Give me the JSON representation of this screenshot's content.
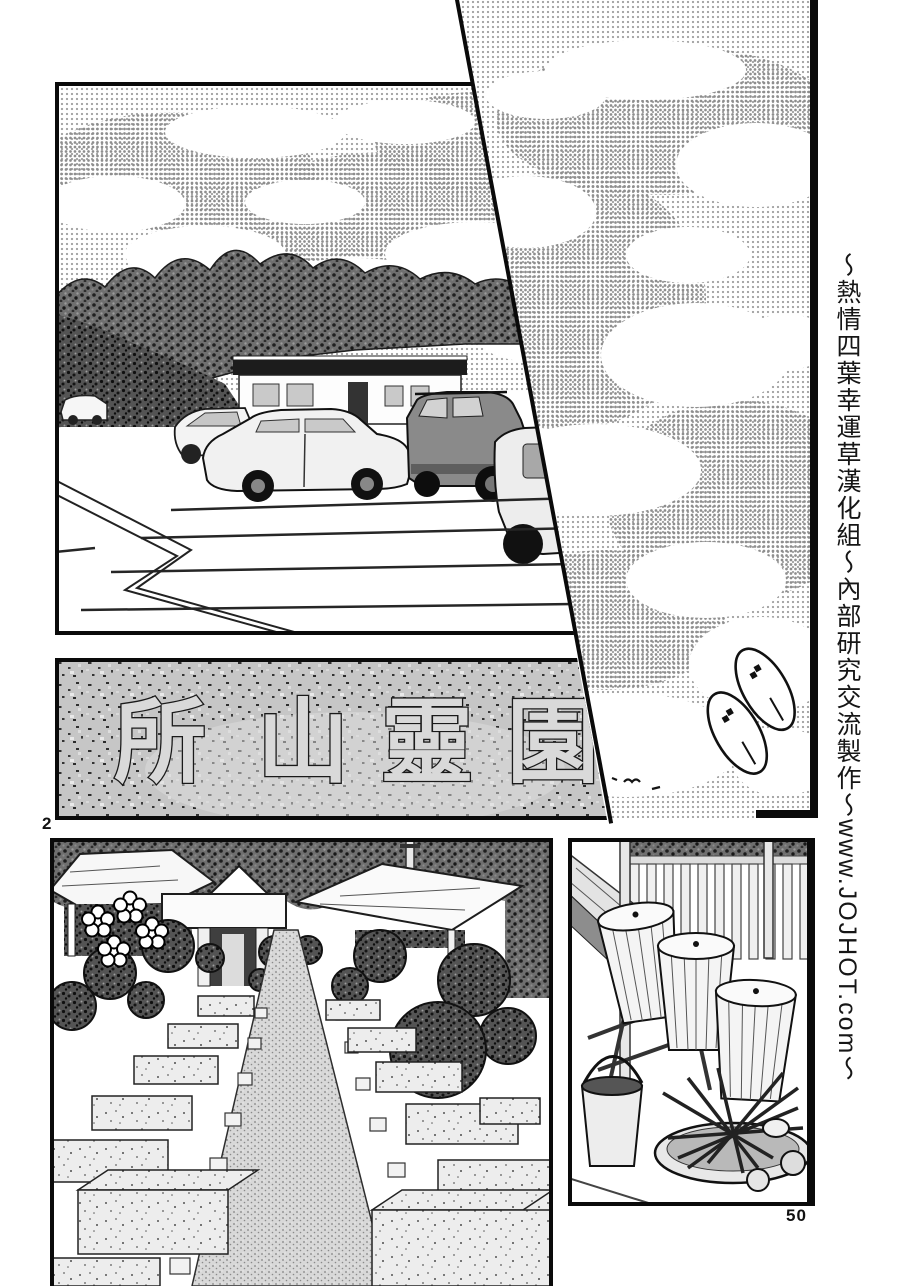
{
  "page": {
    "panel_number": "2",
    "page_number": "50",
    "paper_color": "#ffffff",
    "ink_color": "#0a0a0a",
    "halftone_gray": "#a2a2a2",
    "stone_gray": "#c6c6c6"
  },
  "sidebar_credits": {
    "text": "～熱情四葉幸運草漢化組～內部研究交流製作～www.JOJHOT.com～"
  },
  "stone_sign": {
    "characters": [
      "所",
      "山",
      "靈",
      "園"
    ]
  },
  "panels": {
    "sky": {
      "alt": "halftone sky with white clouds, a pair of sandals motif and distant birds"
    },
    "parking_lot": {
      "alt": "parking lot with parked cars in front of a low building, tree line behind"
    },
    "stone_sign": {
      "alt": "engraved stone name sign of the cemetery"
    },
    "cemetery_path": {
      "alt": "cemetery central gravel path lined with grave plots, shrubs, a gate and pavilions"
    },
    "water_station": {
      "alt": "stacked grave-visit water buckets on a rack, a pail and a basin full of ladles"
    }
  }
}
